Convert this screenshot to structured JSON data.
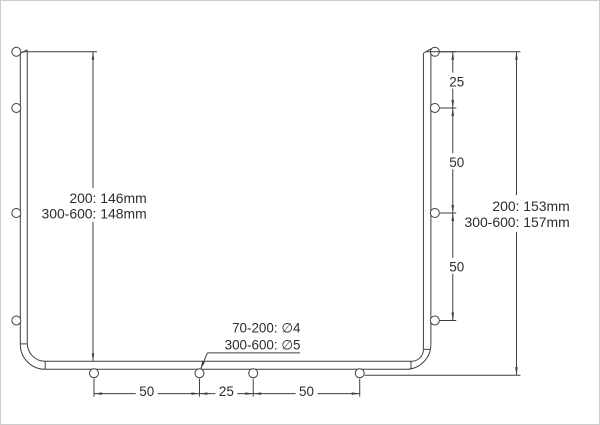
{
  "colors": {
    "line": "#3e3e3e",
    "text": "#2d2d2d",
    "background": "#ffffff",
    "border": "#cccccc"
  },
  "left_dimension": {
    "line1": "200: 146mm",
    "line2": "300-600: 148mm"
  },
  "right_dimension": {
    "line1": "200: 153mm",
    "line2": "300-600: 157mm"
  },
  "hole_note": {
    "line1": "70-200: ∅4",
    "line2": "300-600: ∅5"
  },
  "right_chain": {
    "labels": [
      "25",
      "50",
      "50"
    ]
  },
  "bottom_chain": {
    "labels": [
      "50",
      "25",
      "50"
    ]
  }
}
